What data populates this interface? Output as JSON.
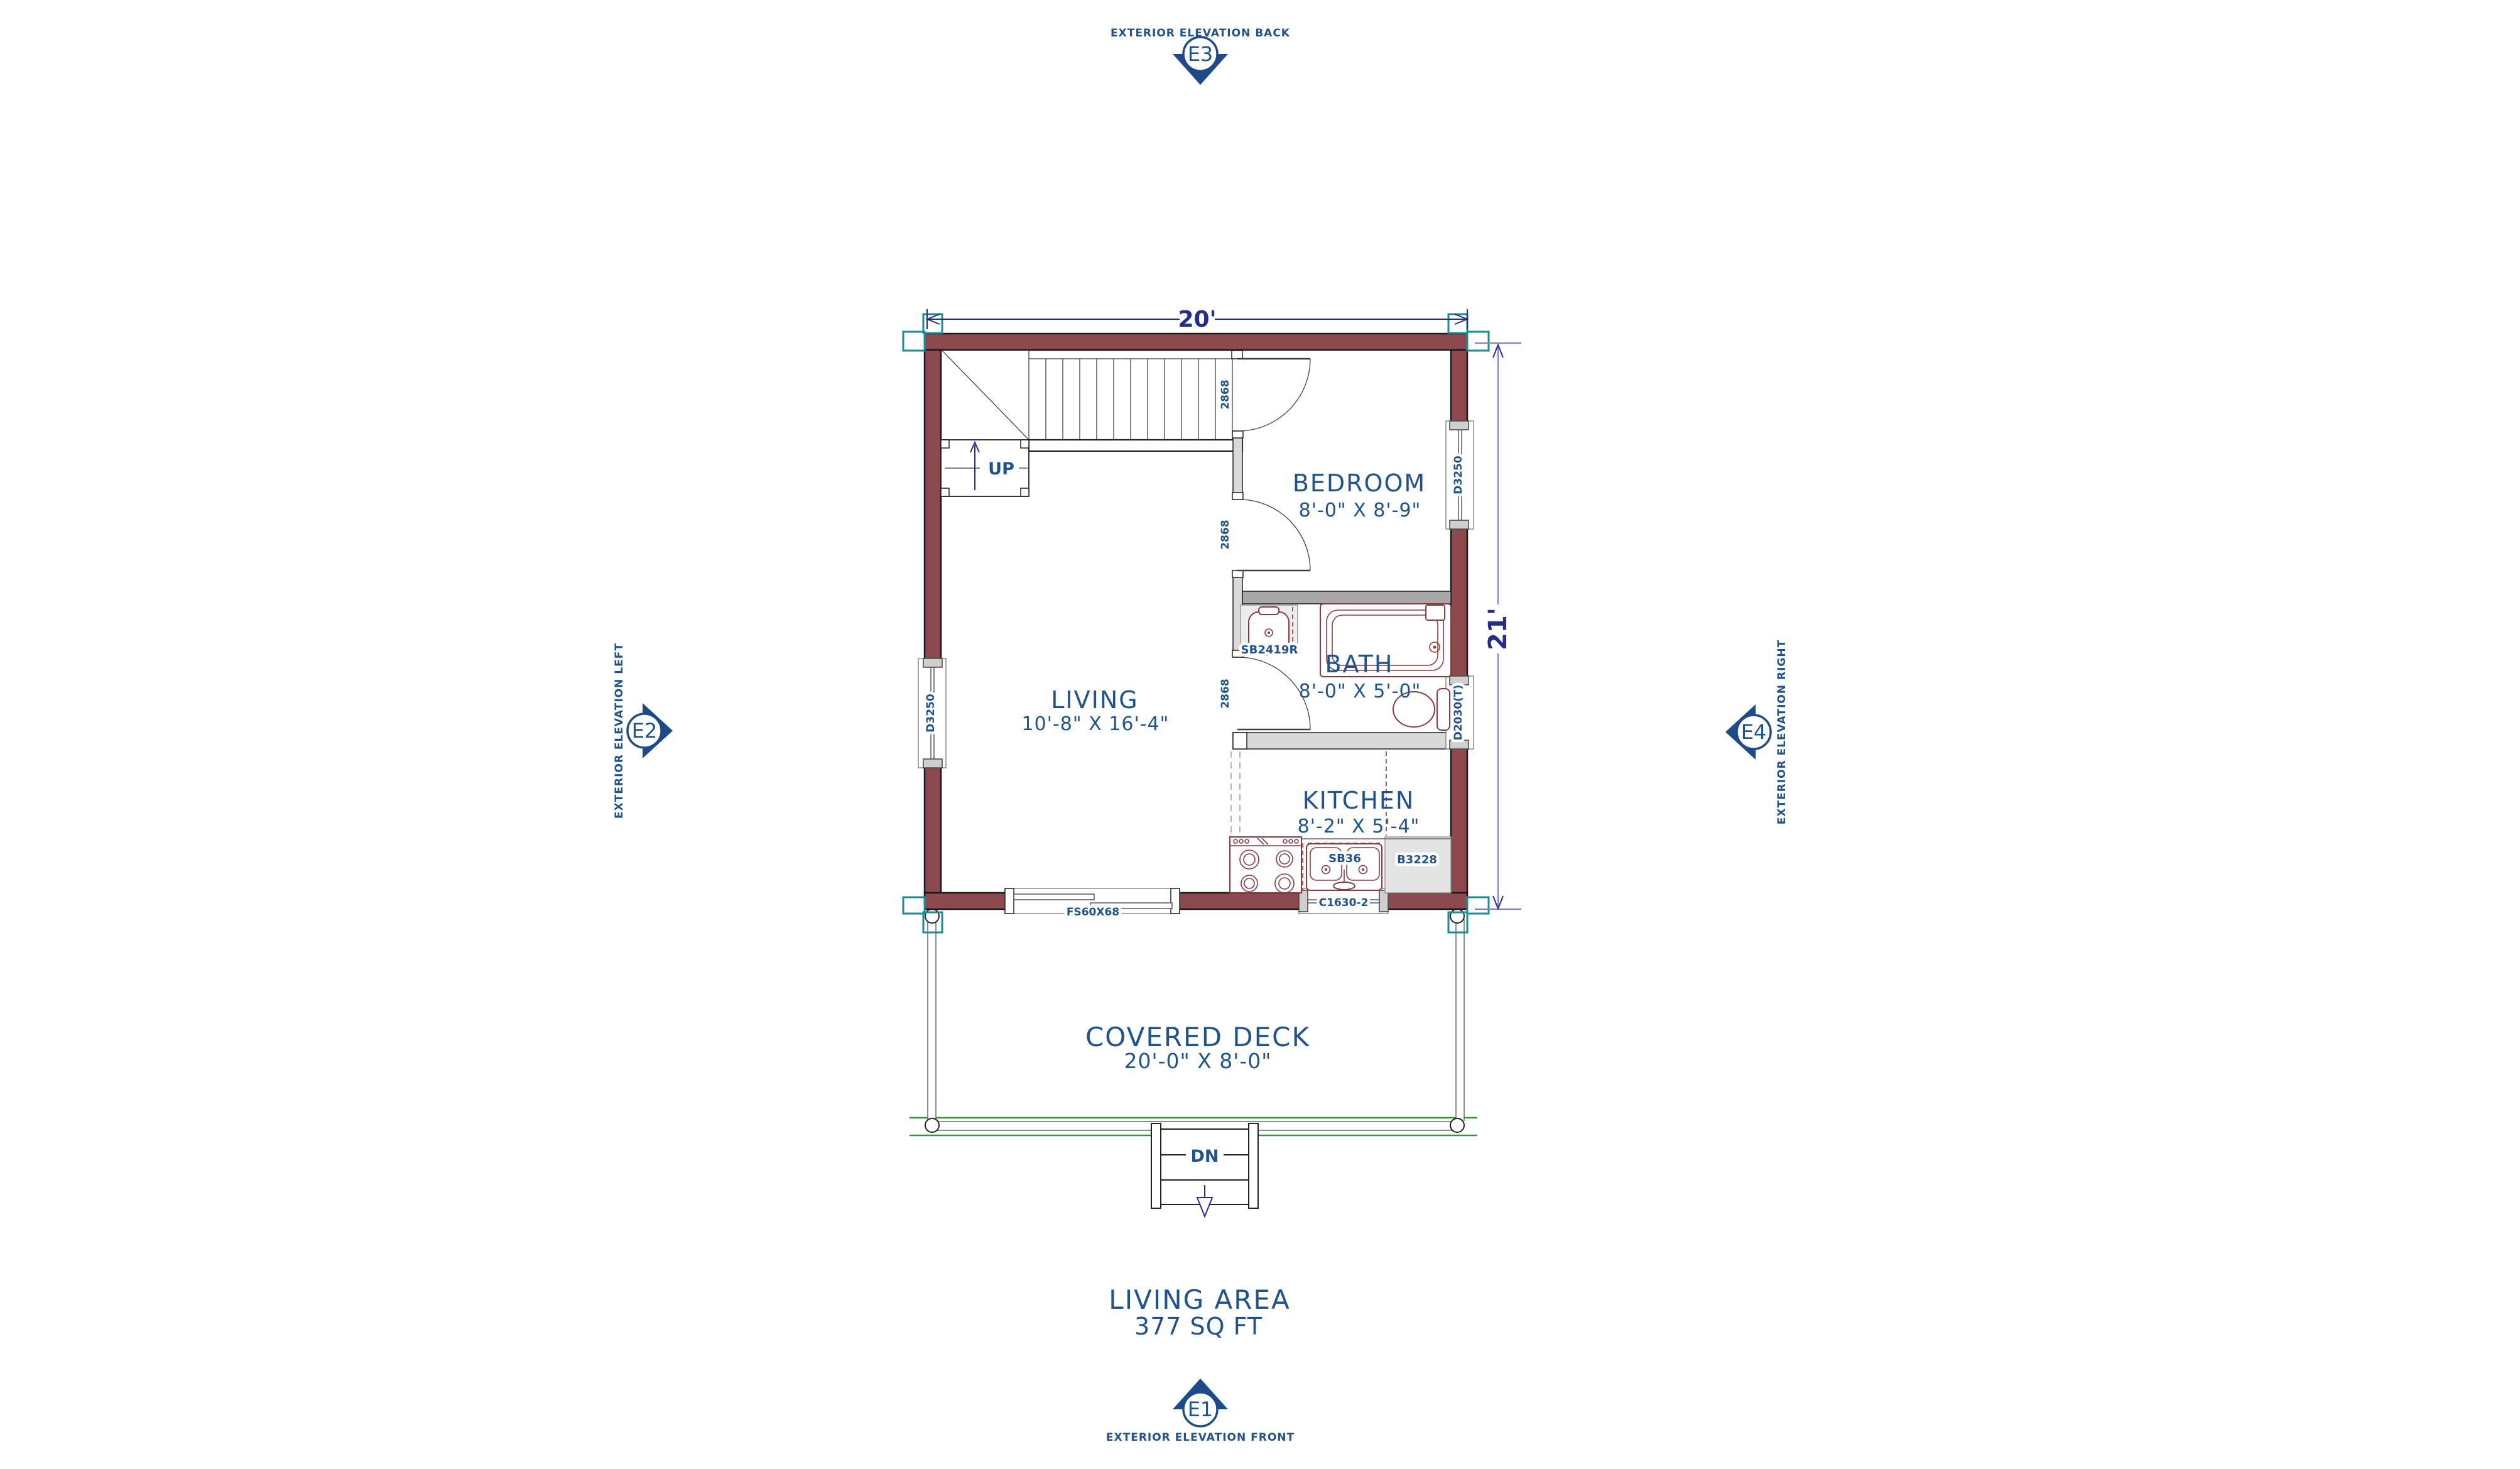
{
  "plan": {
    "dimension_width": "20'",
    "dimension_height": "21'",
    "rooms": {
      "living": {
        "name": "LIVING",
        "size": "10'-8\" X 16'-4\""
      },
      "bedroom": {
        "name": "BEDROOM",
        "size": "8'-0\" X 8'-9\""
      },
      "bath": {
        "name": "BATH",
        "size": "8'-0\" X 5'-0\""
      },
      "kitchen": {
        "name": "KITCHEN",
        "size": "8'-2\" X 5'-4\""
      },
      "deck": {
        "name": "COVERED DECK",
        "size": "20'-0\" X 8'-0\""
      }
    },
    "stairs": {
      "up": "UP",
      "down": "DN"
    },
    "area": {
      "label": "LIVING AREA",
      "value": "377 SQ FT"
    },
    "fixtures": {
      "bath_vanity": "SB2419R",
      "kitchen_sink": "SB36",
      "kitchen_cabinet": "B3228"
    },
    "openings": {
      "living_window": "D3250",
      "bedroom_window": "D3250",
      "bath_window": "D2030(T)",
      "kitchen_window": "C1630-2",
      "deck_slider": "FS60X68",
      "stair_door": "2868",
      "bedroom_door": "2868",
      "bath_door": "2868"
    },
    "elevations": {
      "back": {
        "code": "E3",
        "caption": "EXTERIOR ELEVATION BACK"
      },
      "front": {
        "code": "E1",
        "caption": "EXTERIOR ELEVATION FRONT"
      },
      "left": {
        "code": "E2",
        "caption": "EXTERIOR ELEVATION LEFT"
      },
      "right": {
        "code": "E4",
        "caption": "EXTERIOR ELEVATION RIGHT"
      }
    },
    "colors": {
      "exterior_wall": "#8c4a4f",
      "interior_wall": "#d9d9d9",
      "divider_wall": "#a8a8a8",
      "label_text": "#1e5390",
      "dimension_text": "#232e8c",
      "dimension_line": "#8480cf",
      "fixture_line": "#8c3b40",
      "deck_line": "#2e9c33",
      "corner_marker": "#168f96"
    }
  }
}
